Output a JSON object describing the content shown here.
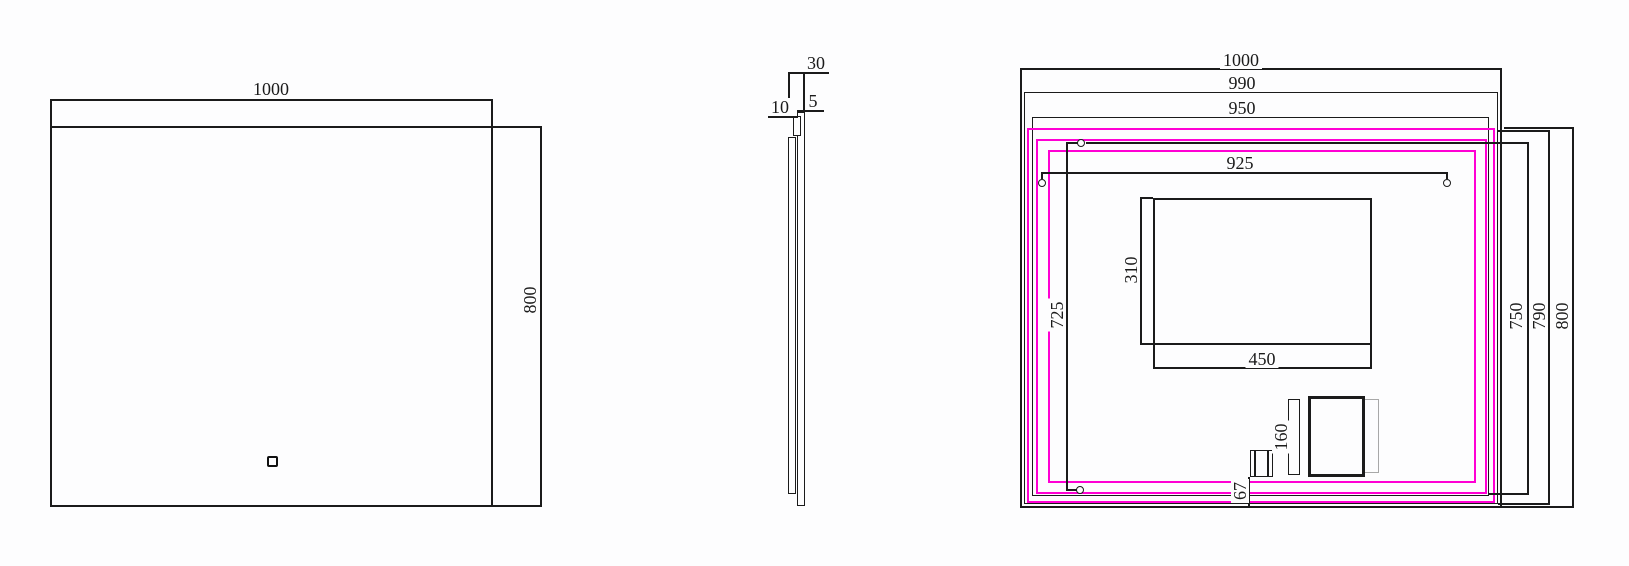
{
  "drawing_title": "LED mirror technical drawing (front, side, back views)",
  "front": {
    "width": "1000",
    "height": "800"
  },
  "side": {
    "depth": "30",
    "glass_thickness": "5",
    "backplate_thickness": "10"
  },
  "back": {
    "overall_width": "1000",
    "backplate_width": "990",
    "frame_width": "950",
    "hanger_spacing": "925",
    "overall_height": "800",
    "backplate_height": "790",
    "frame_height": "750",
    "led_loop_height": "725",
    "demister_width": "450",
    "demister_height": "310",
    "driver_length": "160",
    "switch_offset": "67"
  },
  "colors": {
    "line": "#1b1b1b",
    "led_strip": "#ff00d4",
    "ghost_outline": "#a8a8a8",
    "background": "#fdfdfe"
  }
}
